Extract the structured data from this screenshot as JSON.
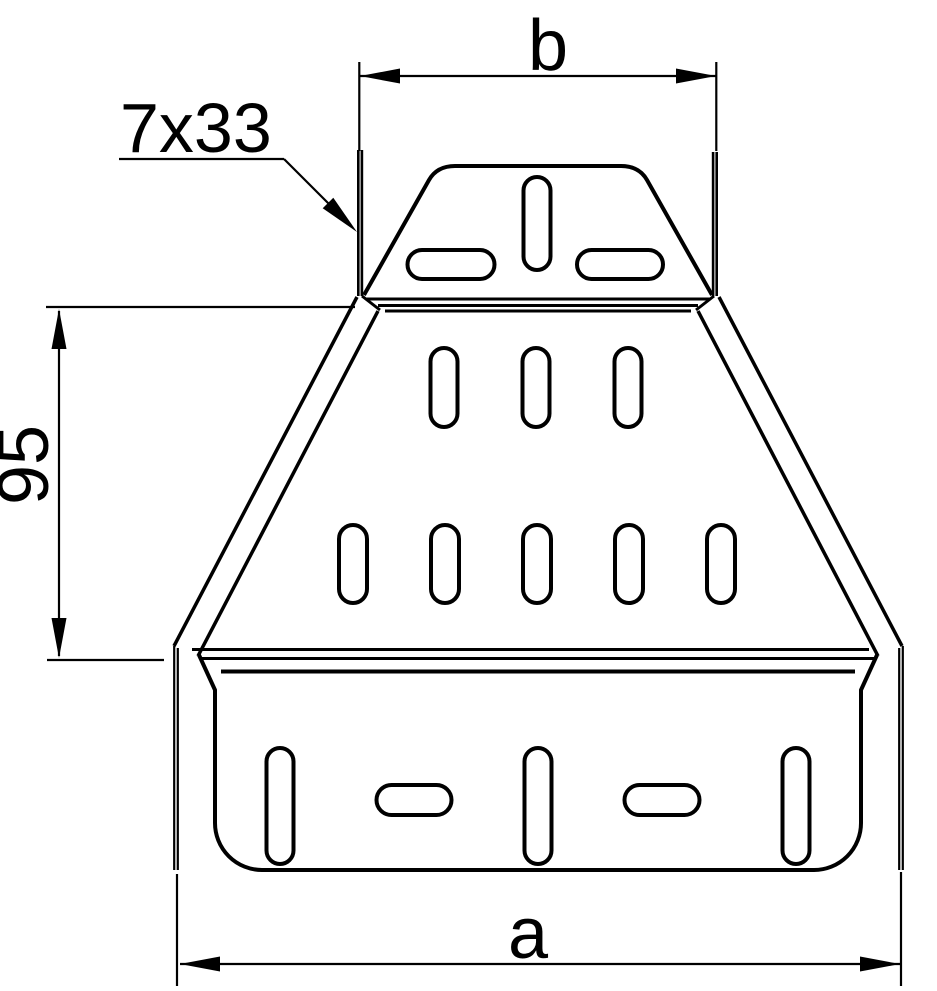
{
  "drawing": {
    "background": "#ffffff",
    "line_color": "#000000",
    "labels": {
      "width_top": "b",
      "width_bottom": "a",
      "transition_height": "95",
      "slot_size": "7x33"
    }
  }
}
